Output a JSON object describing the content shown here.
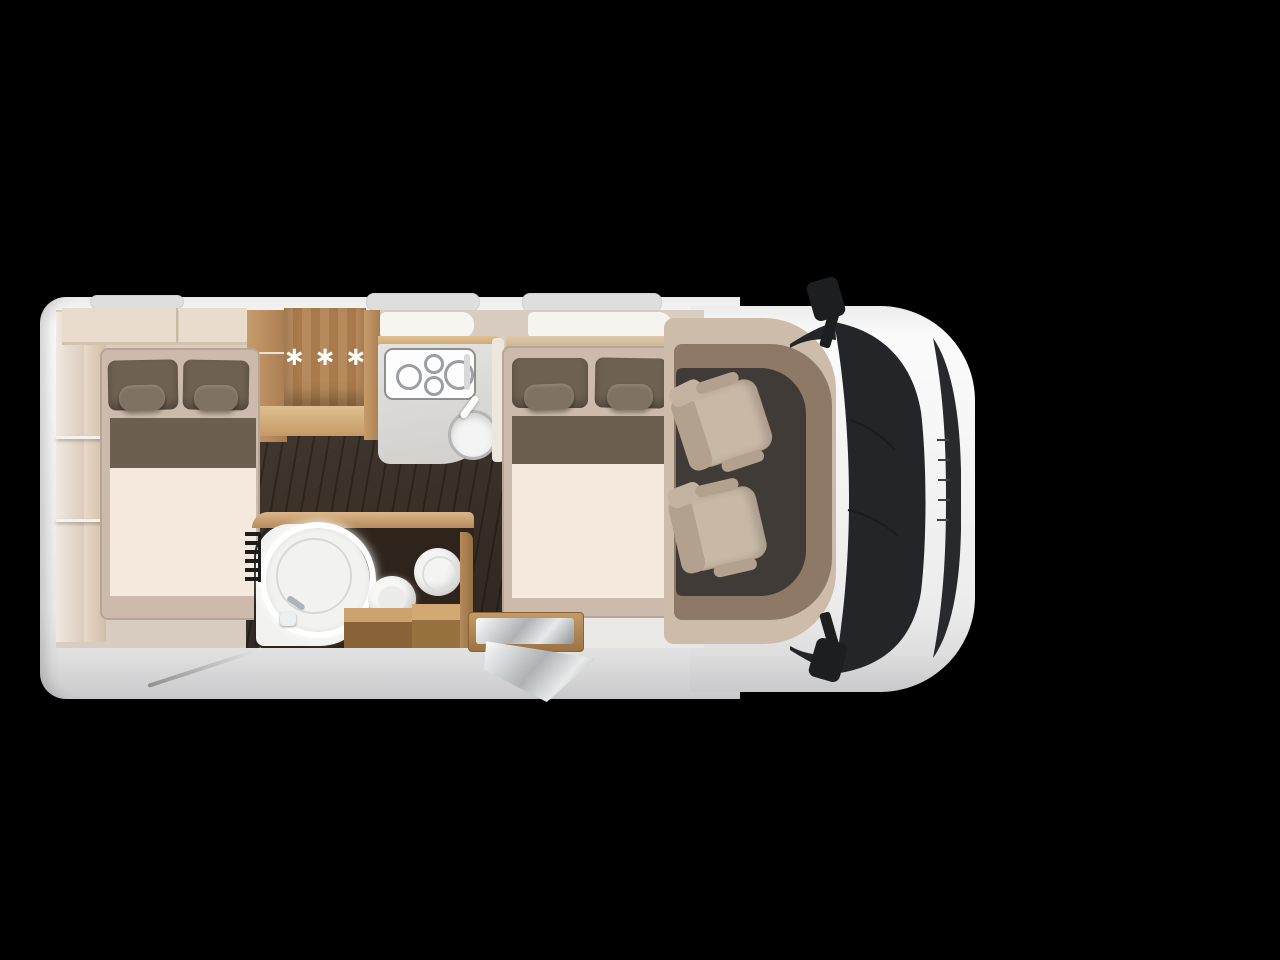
{
  "meta": {
    "scene": "motorhome-floor-plan-top-view",
    "canvas": {
      "width": 1280,
      "height": 960
    },
    "background": "#000000"
  },
  "vehicle": {
    "view": "top-down cutaway render",
    "front_direction": "right",
    "fridge": {
      "label": "∗∗∗"
    },
    "counts": {
      "double_beds": 2,
      "pillows_per_bed": 2,
      "cab_seats": 2,
      "hob_burners": 4,
      "roof_hatches": 3,
      "side_mirrors": 2
    },
    "features": [
      {
        "name": "rear-wall-shelving"
      },
      {
        "name": "overhead-cabinets"
      },
      {
        "name": "rear-double-bed"
      },
      {
        "name": "wardrobe"
      },
      {
        "name": "fridge-freezer",
        "marking": "∗∗∗"
      },
      {
        "name": "kitchen-hob"
      },
      {
        "name": "kitchen-sink"
      },
      {
        "name": "kitchen-window"
      },
      {
        "name": "bathroom-shower-illuminated"
      },
      {
        "name": "washbasin"
      },
      {
        "name": "toilet"
      },
      {
        "name": "wall-heater"
      },
      {
        "name": "bathroom-cabinets"
      },
      {
        "name": "mid-double-bed"
      },
      {
        "name": "entry-step"
      },
      {
        "name": "entry-door-open"
      },
      {
        "name": "dashboard"
      },
      {
        "name": "cab-swivel-seat-upper"
      },
      {
        "name": "cab-swivel-seat-lower"
      },
      {
        "name": "windshield"
      },
      {
        "name": "front-grille"
      },
      {
        "name": "side-mirror-top"
      },
      {
        "name": "side-mirror-bottom"
      },
      {
        "name": "roof-hatches"
      },
      {
        "name": "antenna-rod"
      }
    ]
  },
  "colors": {
    "background": "#000000",
    "body_white": "#f3f3f3",
    "body_shade": "#c9c9cb",
    "interior_wall": "#d9ccc0",
    "wood_light": "#e8dac8",
    "wood_mid": "#c79c6d",
    "wood_dark": "#a97d4f",
    "floor_dark": "#352c24",
    "bathroom_dark": "#2e241c",
    "mattress": "#f5e8dd",
    "bed_frame": "#ccbbac",
    "pillow": "#6e6052",
    "blanket_runner": "#6c5e51",
    "counter_grey": "#d9d8d5",
    "appliance_white": "#fafafa",
    "cab_trim_light": "#cebcab",
    "cab_trim_dark": "#8d7966",
    "cab_floor": "#403b36",
    "seat_beige": "#c8b8a6",
    "windshield_dark": "#232528",
    "mirror_black": "#1d1e1f",
    "shower_glow": "#ffffff"
  }
}
